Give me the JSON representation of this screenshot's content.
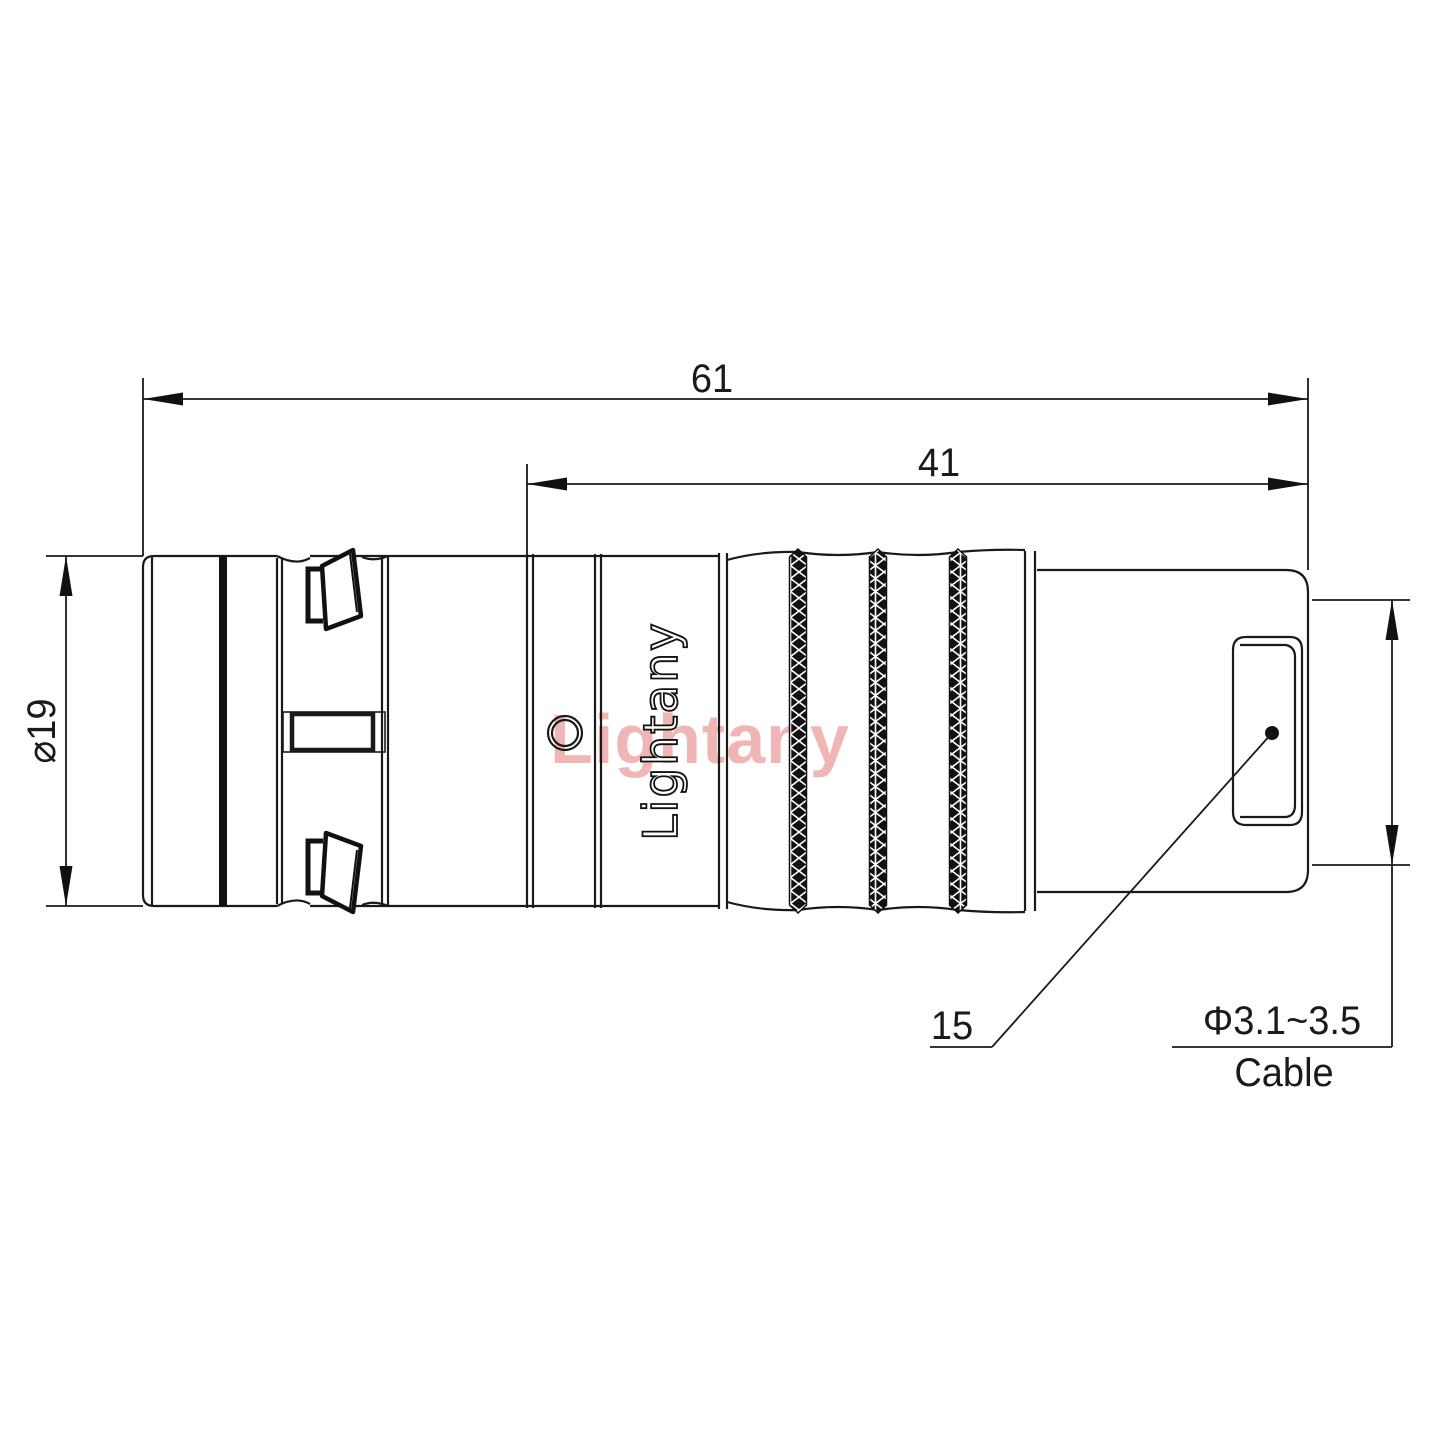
{
  "drawing": {
    "type": "engineering-drawing-connector-side-view",
    "dimensions": {
      "overall_length": "61",
      "inner_length": "41",
      "body_diameter": "⌀19",
      "rear_section_length": "15",
      "cable_diameter_range": "Φ3.1~3.5",
      "cable_label": "Cable"
    },
    "brand_logo": "Lightany",
    "watermark": "Lightany",
    "colors": {
      "line": "#1a1a1a",
      "watermark": "#f0b6b6",
      "background": "#ffffff"
    }
  }
}
